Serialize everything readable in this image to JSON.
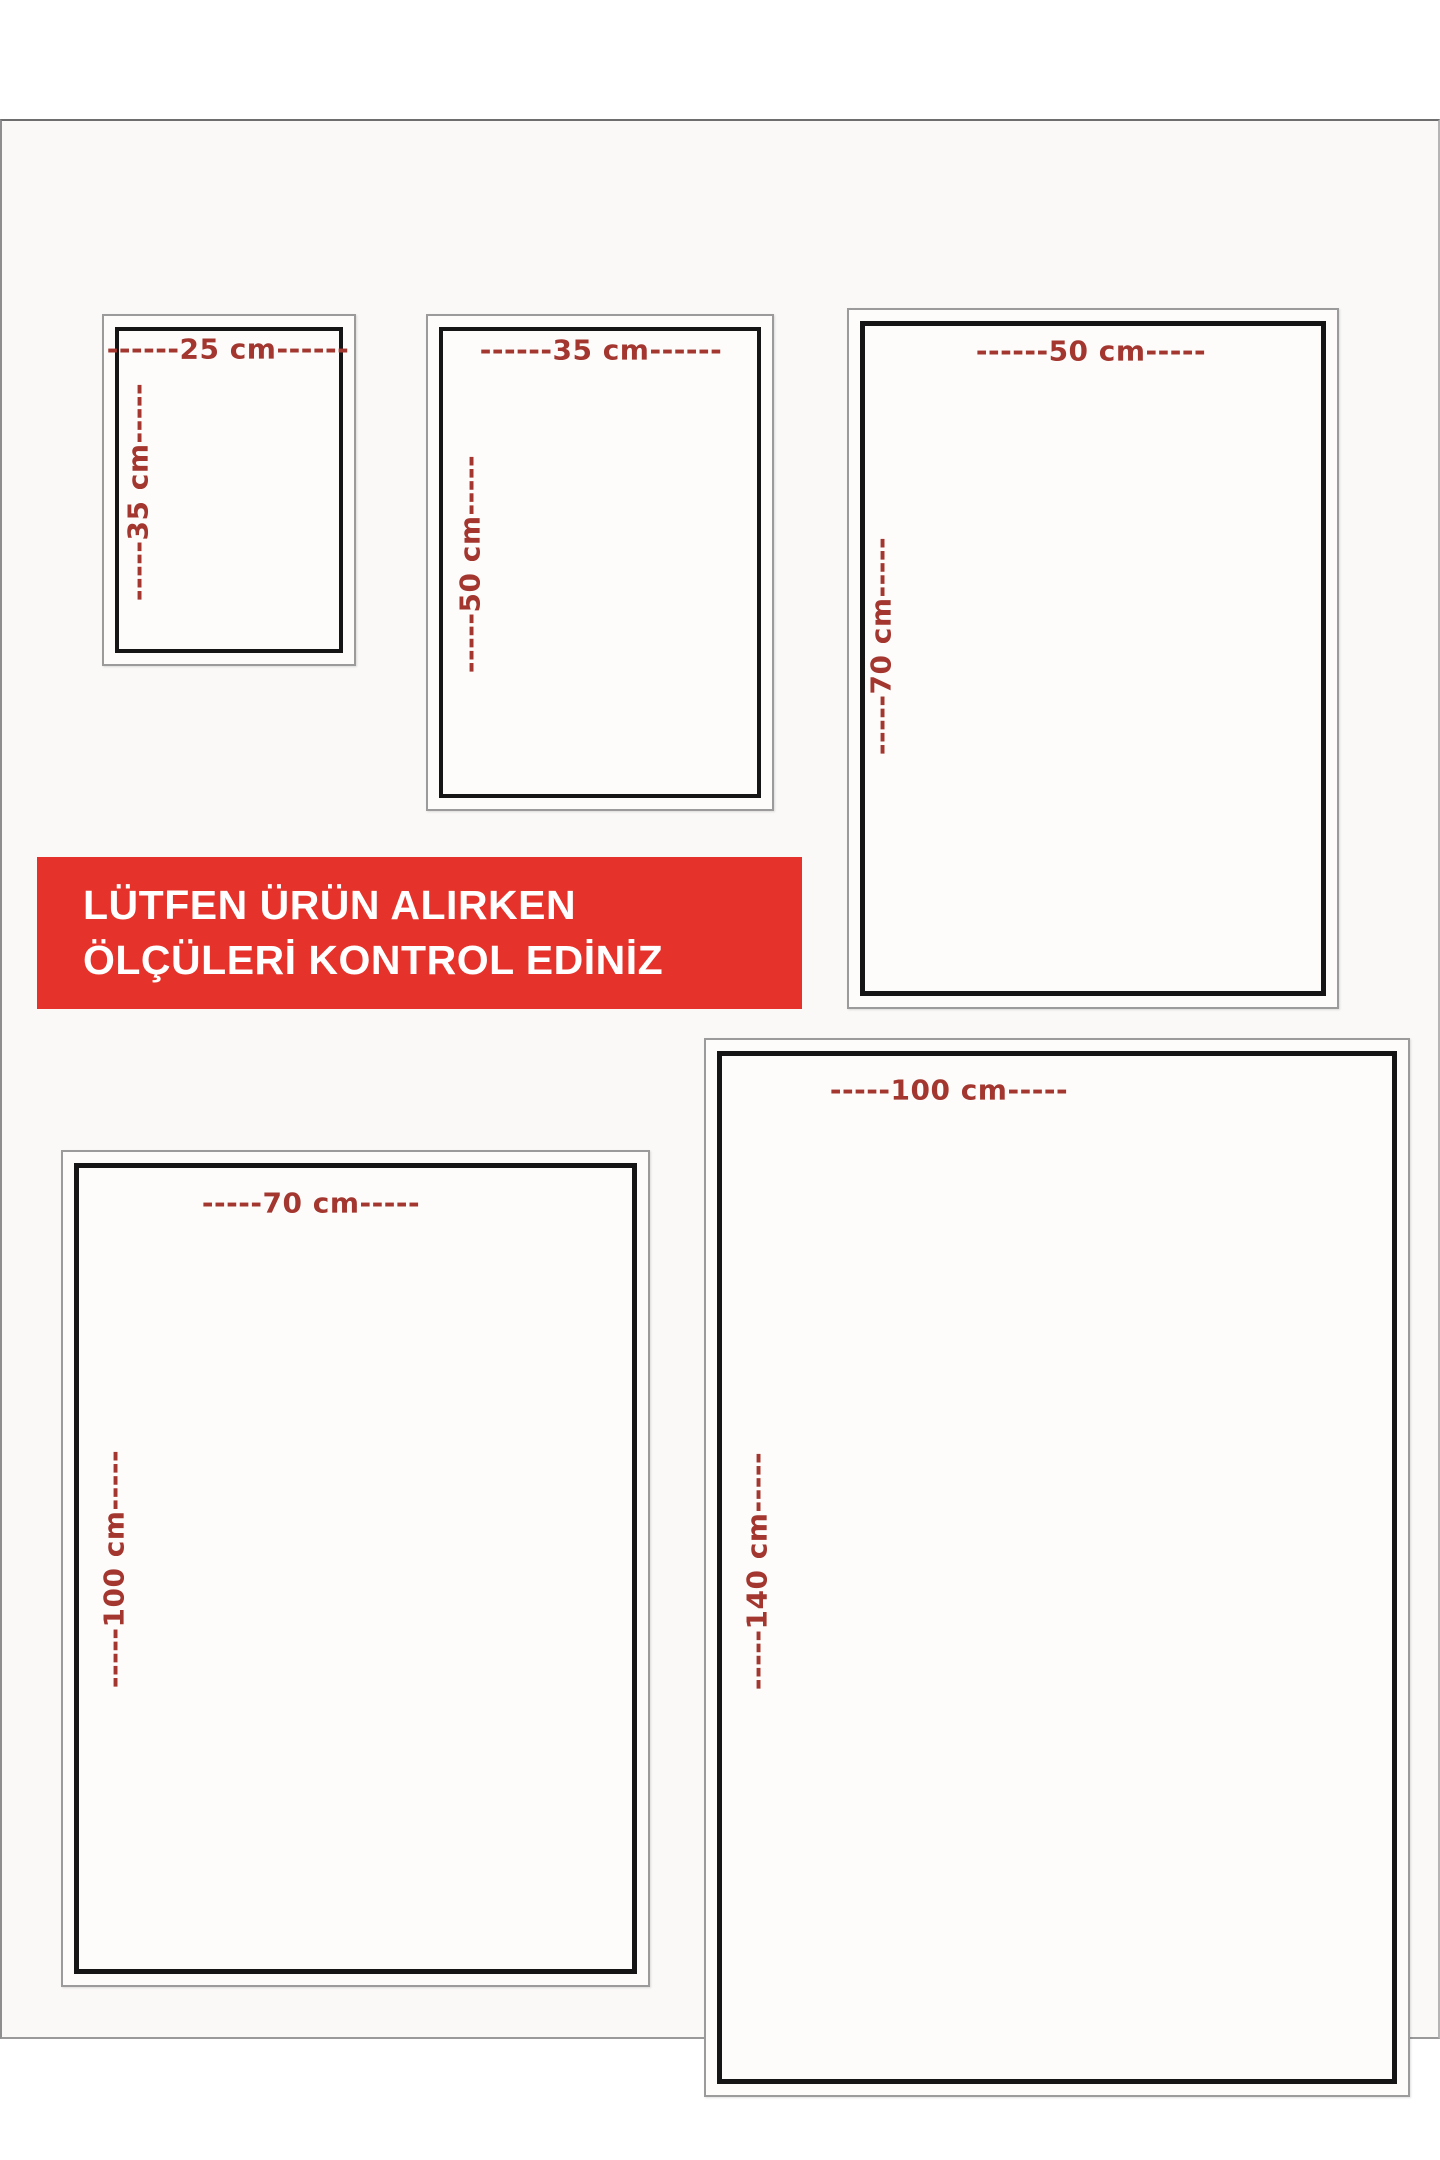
{
  "notice": {
    "line1": "LÜTFEN ÜRÜN ALIRKEN",
    "line2": "ÖLÇÜLERİ KONTROL EDİNİZ"
  },
  "colors": {
    "banner_background": "#e5322a",
    "banner_text": "#ffffff",
    "dimension_label": "#a3372f",
    "frame_border": "#151515",
    "outer_frame_border": "#9b9b9b",
    "panel_background": "#faf9f7",
    "page_background": "#ffffff"
  },
  "sizes": [
    {
      "name": "25x35",
      "width_cm": 25,
      "height_cm": 35,
      "width_label": "------25 cm------",
      "height_label": "-----35 cm-----"
    },
    {
      "name": "35x50",
      "width_cm": 35,
      "height_cm": 50,
      "width_label": "------35 cm------",
      "height_label": "-----50 cm-----"
    },
    {
      "name": "50x70",
      "width_cm": 50,
      "height_cm": 70,
      "width_label": "------50 cm-----",
      "height_label": "-----70 cm-----"
    },
    {
      "name": "70x100",
      "width_cm": 70,
      "height_cm": 100,
      "width_label": "-----70 cm-----",
      "height_label": "-----100 cm-----"
    },
    {
      "name": "100x140",
      "width_cm": 100,
      "height_cm": 140,
      "width_label": "-----100 cm-----",
      "height_label": "-----140 cm-----"
    }
  ]
}
